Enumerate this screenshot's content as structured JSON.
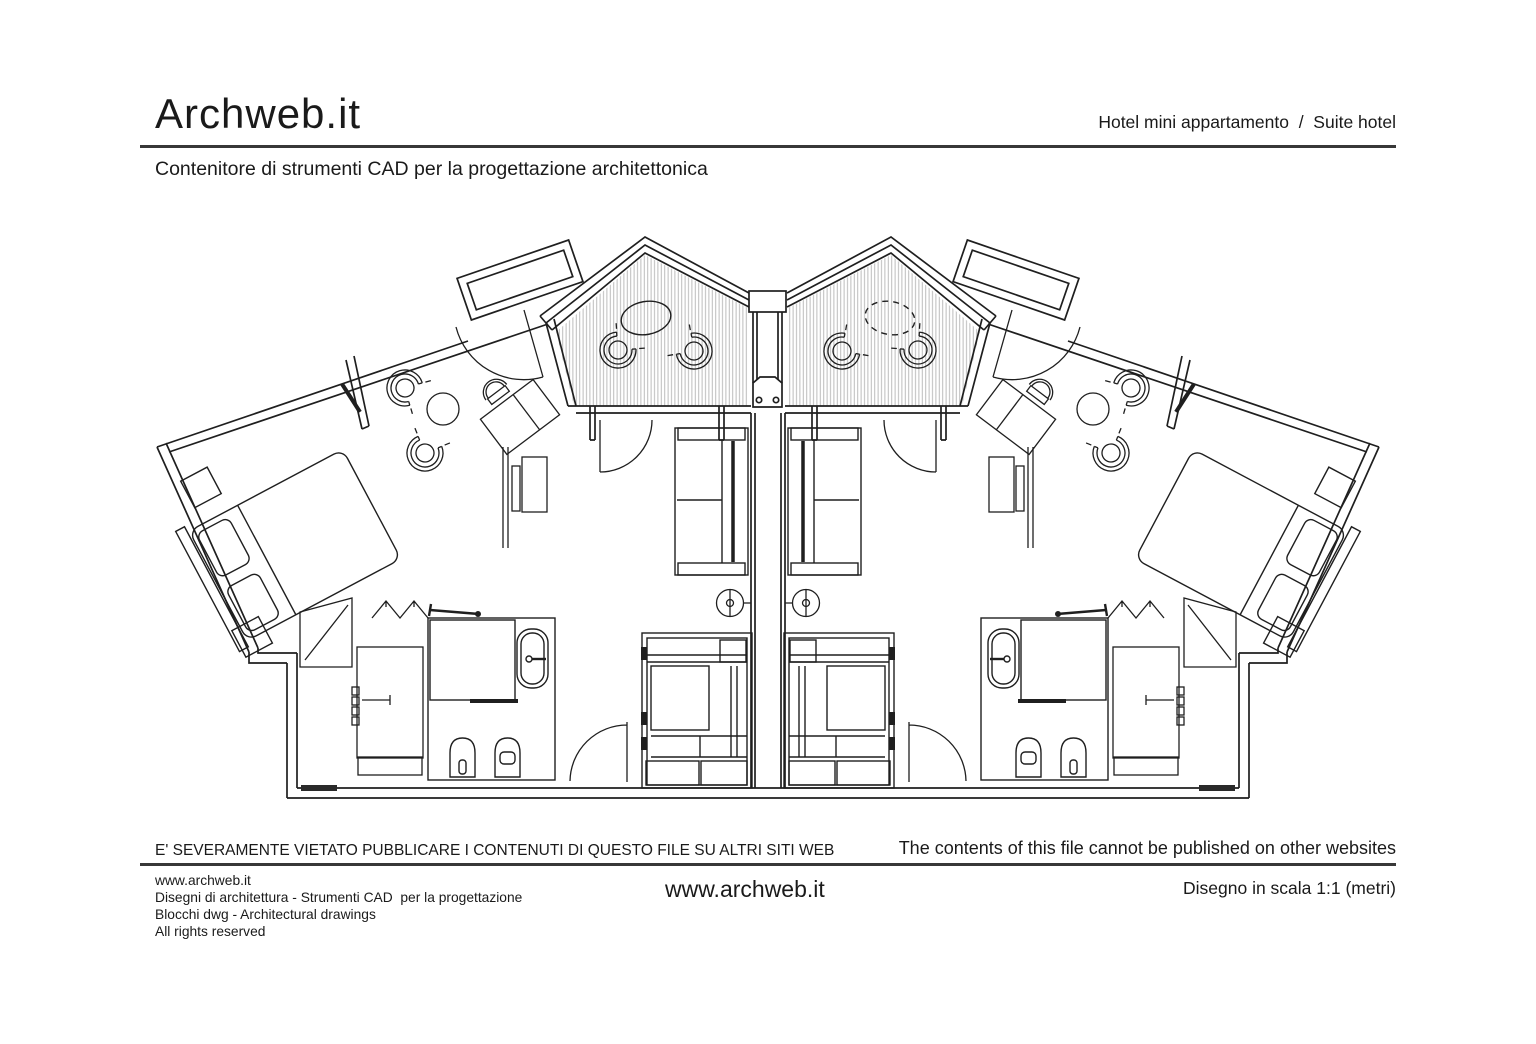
{
  "header": {
    "logo": "Archweb.it",
    "category": "Hotel mini appartamento  /  Suite hotel",
    "subtitle": "Contenitore di strumenti CAD per la progettazione architettonica"
  },
  "plan": {
    "description": "Floor plan of two mirrored hotel mini-apartment suites (suite hotel) with hatched gabled terraces, double bedrooms, sitting areas, wardrobes and bathrooms",
    "line_color": "#1f1f1f",
    "hatch_color": "#b3b3b3"
  },
  "notice": {
    "italian": "E' SEVERAMENTE VIETATO PUBBLICARE I CONTENUTI DI QUESTO FILE SU ALTRI SITI WEB",
    "english": "The contents of this file cannot be published on other websites"
  },
  "footer": {
    "site": "www.archweb.it",
    "line2": "Disegni di architettura - Strumenti CAD  per la progettazione",
    "line3": "Blocchi dwg - Architectural drawings",
    "line4": "All rights reserved",
    "center_site": "www.archweb.it",
    "scale_label": "Disegno in scala 1:1 (metri)"
  }
}
